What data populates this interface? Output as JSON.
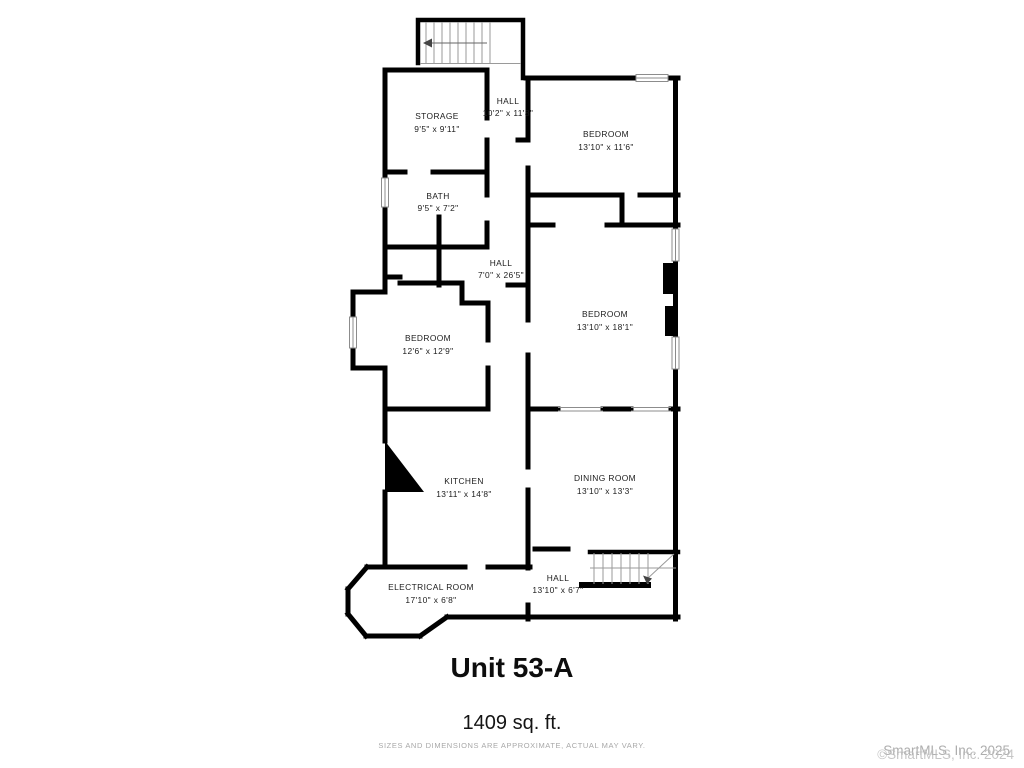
{
  "plan": {
    "rooms": [
      {
        "name": "STORAGE",
        "dims": "9'5\" x 9'11\""
      },
      {
        "name": "HALL",
        "dims": "10'2\" x 11'8\""
      },
      {
        "name": "BEDROOM",
        "dims": "13'10\" x 11'6\""
      },
      {
        "name": "BATH",
        "dims": "9'5\" x 7'2\""
      },
      {
        "name": "HALL",
        "dims": "7'0\" x 26'5\""
      },
      {
        "name": "BEDROOM",
        "dims": "13'10\" x 18'1\""
      },
      {
        "name": "BEDROOM",
        "dims": "12'6\" x 12'9\""
      },
      {
        "name": "KITCHEN",
        "dims": "13'11\" x 14'8\""
      },
      {
        "name": "DINING ROOM",
        "dims": "13'10\" x 13'3\""
      },
      {
        "name": "ELECTRICAL ROOM",
        "dims": "17'10\" x 6'8\""
      },
      {
        "name": "HALL",
        "dims": "13'10\" x 6'7\""
      }
    ],
    "colors": {
      "wall": "#000000",
      "window_line": "#8c8c8c",
      "label": "#1c1c1c"
    }
  },
  "footer": {
    "unit_title": "Unit 53-A",
    "area": "1409 sq. ft.",
    "disclaimer": "SIZES AND DIMENSIONS ARE APPROXIMATE, ACTUAL MAY VARY."
  },
  "watermark": {
    "line1": "SmartMLS, Inc. 2025",
    "line2": "©SmartMLS, Inc. 2024"
  }
}
